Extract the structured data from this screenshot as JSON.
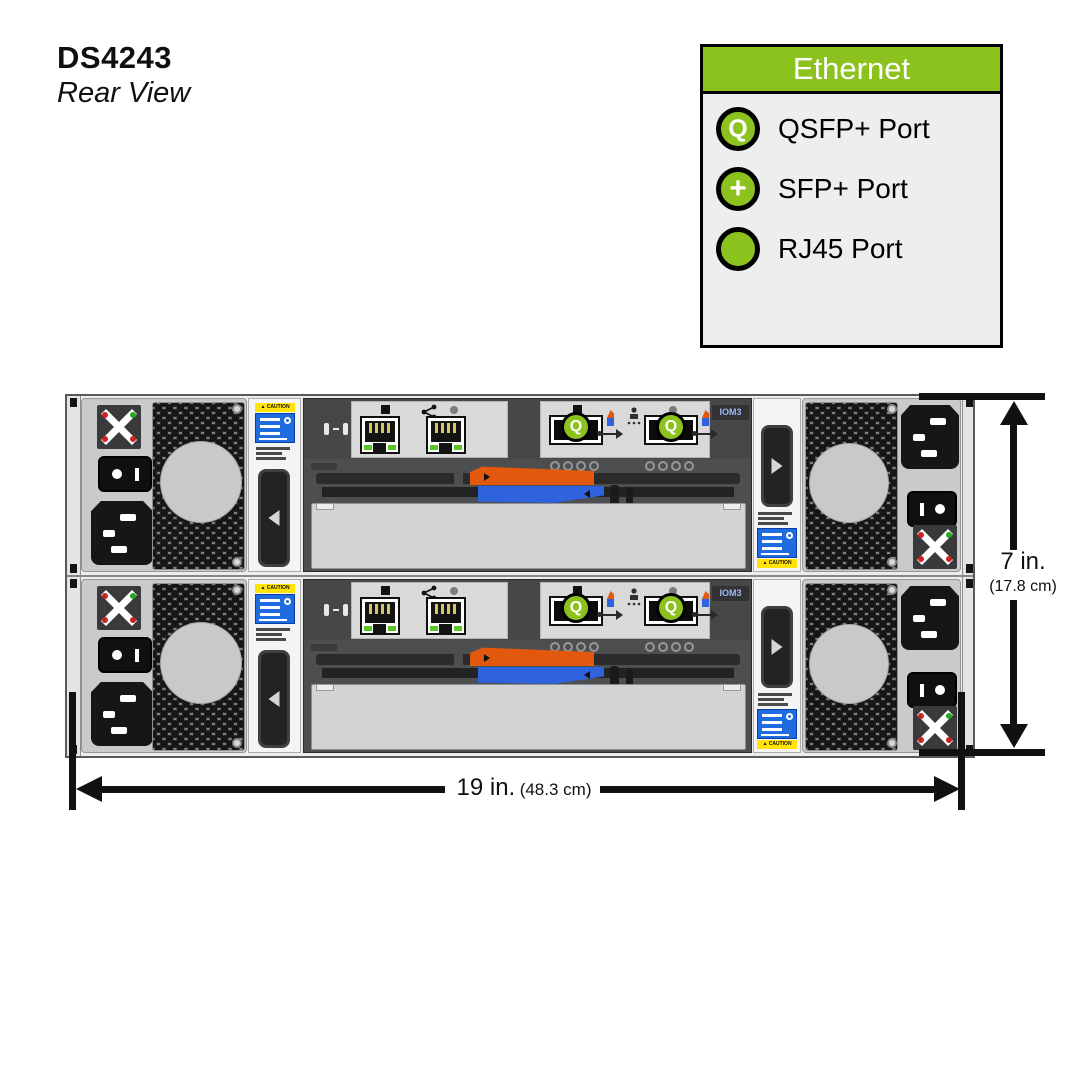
{
  "page": {
    "title": "DS4243",
    "subtitle": "Rear View"
  },
  "legend": {
    "title": "Ethernet",
    "items": [
      {
        "symbol": "Q",
        "label": "QSFP+ Port"
      },
      {
        "symbol": "+",
        "label": "SFP+ Port"
      },
      {
        "symbol": "",
        "label": "RJ45 Port"
      }
    ]
  },
  "chassis": {
    "rows": 2,
    "iom_badge": "IOM3"
  },
  "labels": {
    "caution_banner": "▲ CAUTION"
  },
  "dimensions": {
    "height_primary": "7 in.",
    "height_secondary": "(17.8 cm)",
    "width_primary": "19 in.",
    "width_secondary": "(48.3 cm)"
  },
  "colors": {
    "accent_green": "#8CC21E",
    "lever_orange": "#E2590D",
    "lever_blue": "#2F63DE",
    "caution_yellow": "#FFE405",
    "caution_blue": "#1F6BE0"
  }
}
